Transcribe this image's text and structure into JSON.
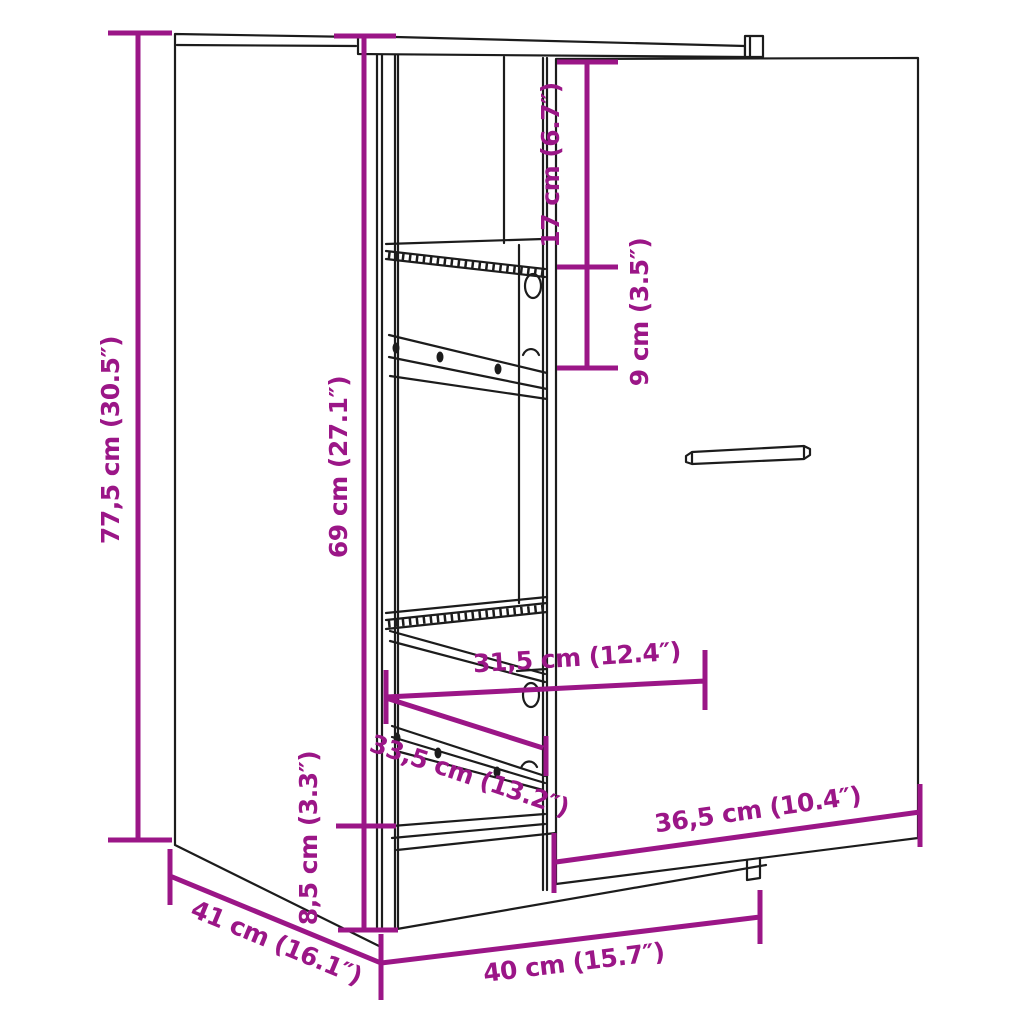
{
  "figure": {
    "type": "furniture-dimension-diagram",
    "subject": "apothecary pull-out cabinet with door front and wire baskets",
    "background_color": "#ffffff",
    "line_color": "#1c1c1c",
    "accent_color": "#9B1687"
  },
  "dimensions": [
    {
      "id": "total-height",
      "label": "77,5 cm (30.5″)",
      "cm": 77.5,
      "inches": 30.5
    },
    {
      "id": "body-height",
      "label": "69 cm (27.1″)",
      "cm": 69,
      "inches": 27.1
    },
    {
      "id": "plinth-height",
      "label": "8,5 cm (3.3″)",
      "cm": 8.5,
      "inches": 3.3
    },
    {
      "id": "top-clearance",
      "label": "17 cm (6.7″)",
      "cm": 17,
      "inches": 6.7
    },
    {
      "id": "shelf-spacing",
      "label": "9 cm (3.5″)",
      "cm": 9,
      "inches": 3.5
    },
    {
      "id": "inner-width",
      "label": "31,5 cm (12.4″)",
      "cm": 31.5,
      "inches": 12.4
    },
    {
      "id": "basket-depth",
      "label": "33,5 cm (13.2″)",
      "cm": 33.5,
      "inches": 13.2
    },
    {
      "id": "front-width",
      "label": "36,5 cm (10.4″)",
      "cm": 36.5,
      "inches": 10.4
    },
    {
      "id": "depth",
      "label": "41 cm (16.1″)",
      "cm": 41,
      "inches": 16.1
    },
    {
      "id": "width",
      "label": "40 cm (15.7″)",
      "cm": 40,
      "inches": 15.7
    }
  ]
}
